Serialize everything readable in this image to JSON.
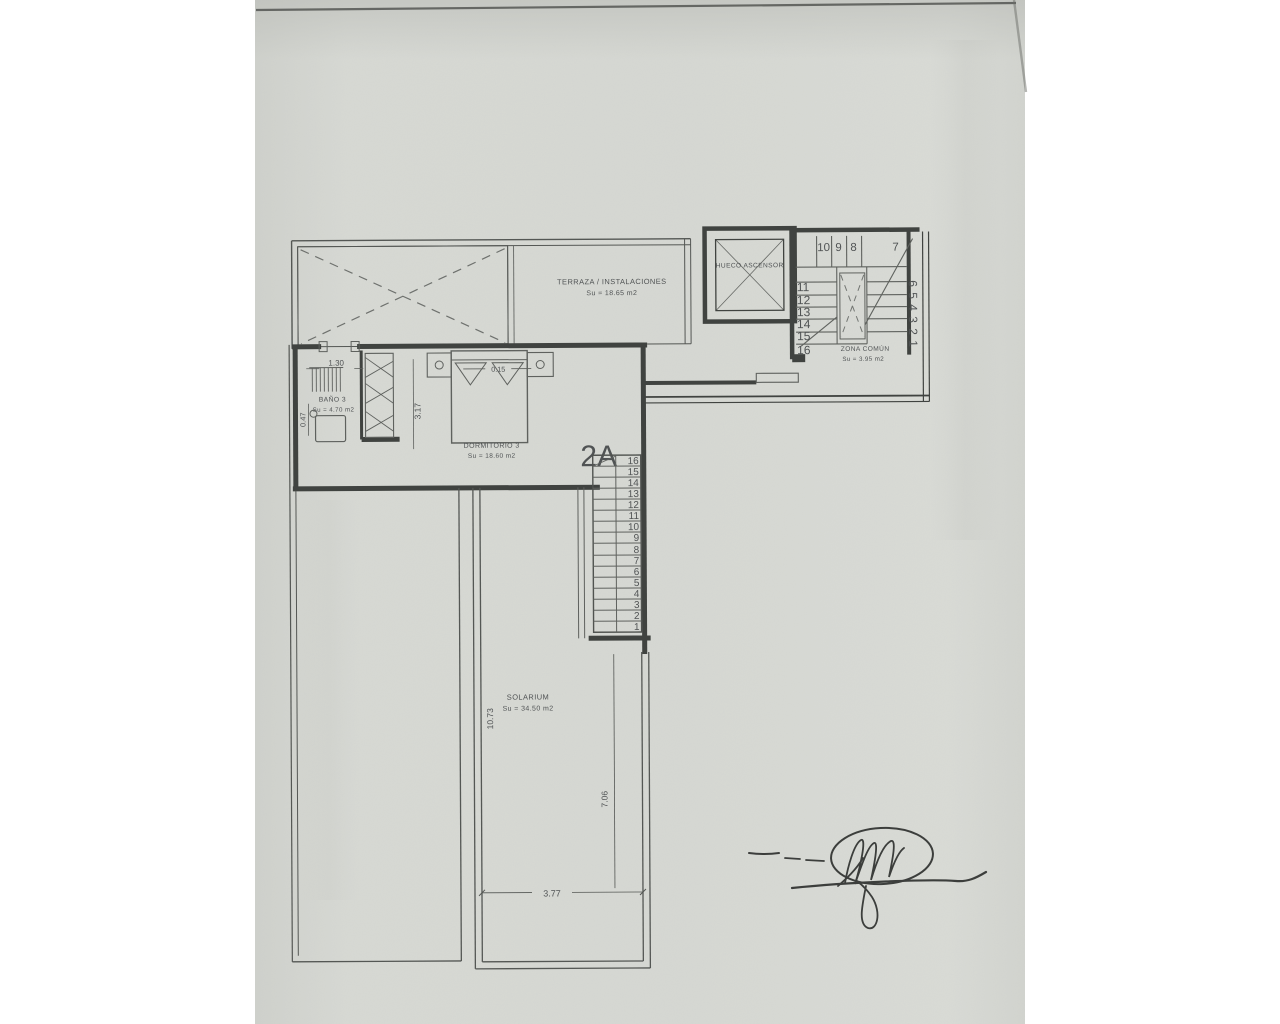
{
  "paper": {
    "background": "#ffffff",
    "paper_color": "#d5d7d2",
    "ink_color": "#383b39"
  },
  "unit": {
    "label": "2A"
  },
  "rooms": {
    "terraza": {
      "label": "TERRAZA / INSTALACIONES",
      "area": "Su = 18.65 m2"
    },
    "ascensor": {
      "label": "HUECO ASCENSOR"
    },
    "zona_comun": {
      "label": "ZONA COMÚN",
      "area": "Su = 3.95 m2"
    },
    "bano": {
      "label": "BAÑO 3",
      "area": "Su = 4.70 m2"
    },
    "dormitorio": {
      "label": "DORMITORIO 3",
      "area": "Su = 18.60 m2"
    },
    "solarium": {
      "label": "SOLARIUM",
      "area": "Su = 34.50 m2"
    }
  },
  "dimensions": {
    "bano_door": "1.30",
    "bano_side": "0.47",
    "dormitorio_side": "3.17",
    "bed_gap": "0.15",
    "solarium_left": "10.73",
    "solarium_right": "7.06",
    "solarium_width": "3.77"
  },
  "stairs_common": {
    "top_row": [
      "10",
      "9",
      "8"
    ],
    "corner": "7",
    "left_col": [
      "11",
      "12",
      "13",
      "14",
      "15",
      "16"
    ],
    "right_col": [
      "6",
      "5",
      "4",
      "3",
      "2",
      "1"
    ]
  },
  "stairs_unit": [
    "16",
    "15",
    "14",
    "13",
    "12",
    "11",
    "10",
    "9",
    "8",
    "7",
    "6",
    "5",
    "4",
    "3",
    "2",
    "1"
  ]
}
